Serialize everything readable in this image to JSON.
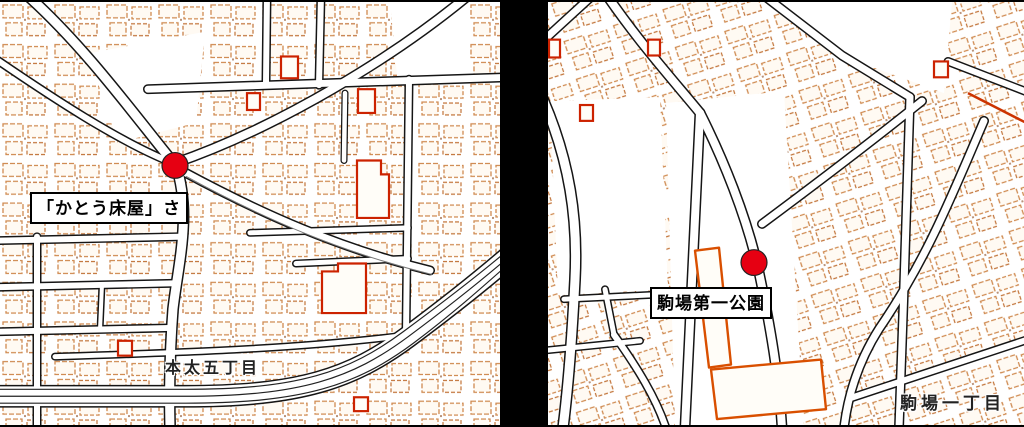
{
  "maps": [
    {
      "name": "left-map",
      "poi_label": "「かとう床屋」さ",
      "area_label": "本太五丁目",
      "marker_color": "#e60012"
    },
    {
      "name": "right-map",
      "poi_label": "駒場第一公園",
      "area_label": "駒場一丁目",
      "marker_color": "#e60012"
    }
  ],
  "palette": {
    "divider": "#000000",
    "map_background": "#ffffff",
    "road_casing": "#151515",
    "road_fill": "#ffffff",
    "building_outline": "#cf8a50",
    "accent_building_outline": "#cc2200",
    "park_outline": "#d94f00",
    "marker_fill": "#e60012",
    "marker_ring": "#222222"
  }
}
